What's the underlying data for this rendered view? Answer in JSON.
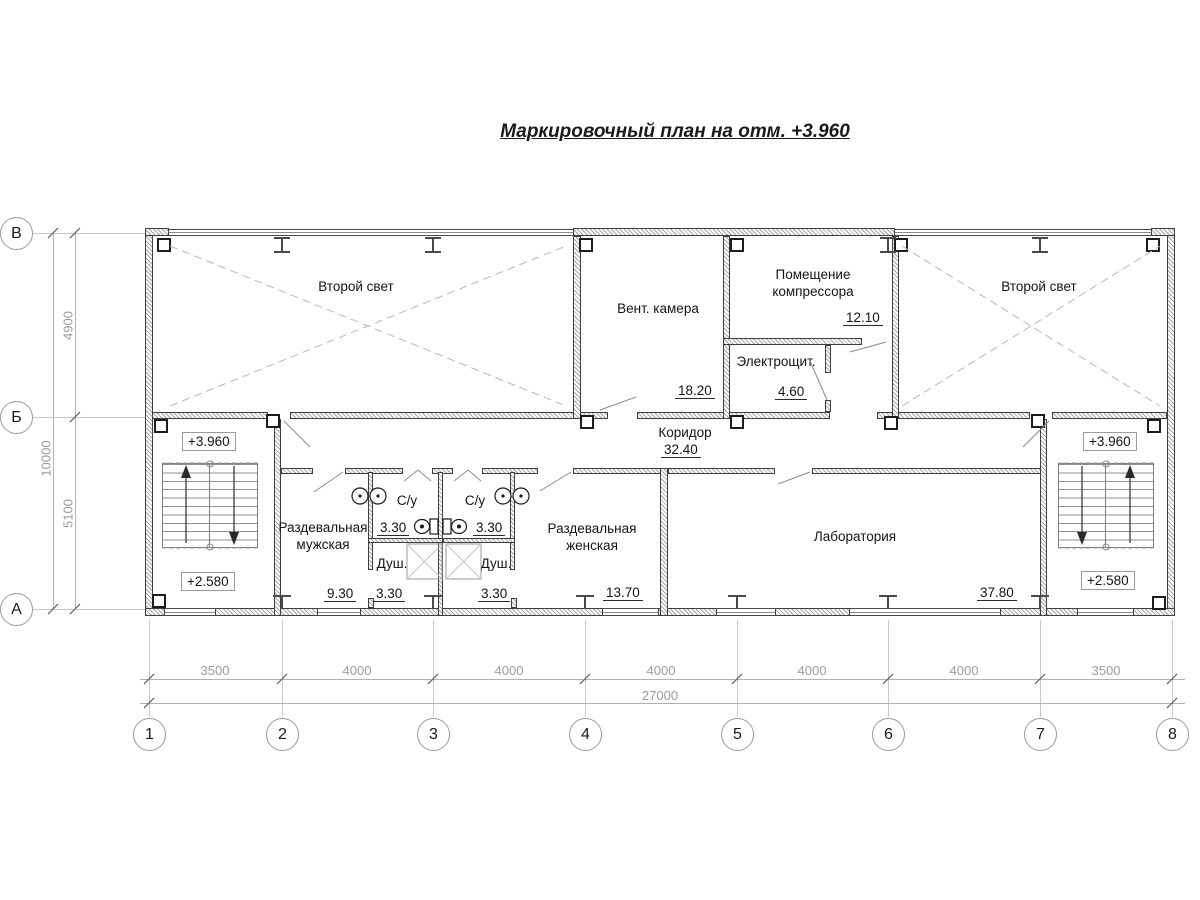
{
  "title": "Маркировочный план на отм. +3.960",
  "axes": {
    "rows": [
      {
        "label": "В"
      },
      {
        "label": "Б"
      },
      {
        "label": "А"
      }
    ],
    "cols": [
      {
        "label": "1"
      },
      {
        "label": "2"
      },
      {
        "label": "3"
      },
      {
        "label": "4"
      },
      {
        "label": "5"
      },
      {
        "label": "6"
      },
      {
        "label": "7"
      },
      {
        "label": "8"
      }
    ]
  },
  "dims": {
    "left_spans": [
      "4900",
      "5100"
    ],
    "left_total": "10000",
    "bottom_spans": [
      "3500",
      "4000",
      "4000",
      "4000",
      "4000",
      "4000",
      "3500"
    ],
    "bottom_total": "27000"
  },
  "rooms": {
    "second_light_left": {
      "name": "Второй свет"
    },
    "vent": {
      "name": "Вент. камера",
      "area": "18.20"
    },
    "compressor": {
      "name": "Помещение компрессора",
      "area": "12.10"
    },
    "electro": {
      "name": "Электрощит.",
      "area": "4.60"
    },
    "second_light_right": {
      "name": "Второй свет"
    },
    "corridor": {
      "name": "Коридор",
      "area": "32.40"
    },
    "locker_men": {
      "name": "Раздевальная мужская",
      "area": "9.30"
    },
    "wc_left": {
      "name": "С/у",
      "area": "3.30"
    },
    "wc_right": {
      "name": "С/у",
      "area": "3.30"
    },
    "shower_left": {
      "name": "Душ.",
      "area": "3.30"
    },
    "shower_right": {
      "name": "Душ.",
      "area": "3.30"
    },
    "locker_women": {
      "name": "Раздевальная женская",
      "area": "13.70"
    },
    "lab": {
      "name": "Лаборатория",
      "area": "37.80"
    }
  },
  "elevations": {
    "left_upper": "+3.960",
    "left_lower": "+2.580",
    "right_upper": "+3.960",
    "right_lower": "+2.580"
  }
}
